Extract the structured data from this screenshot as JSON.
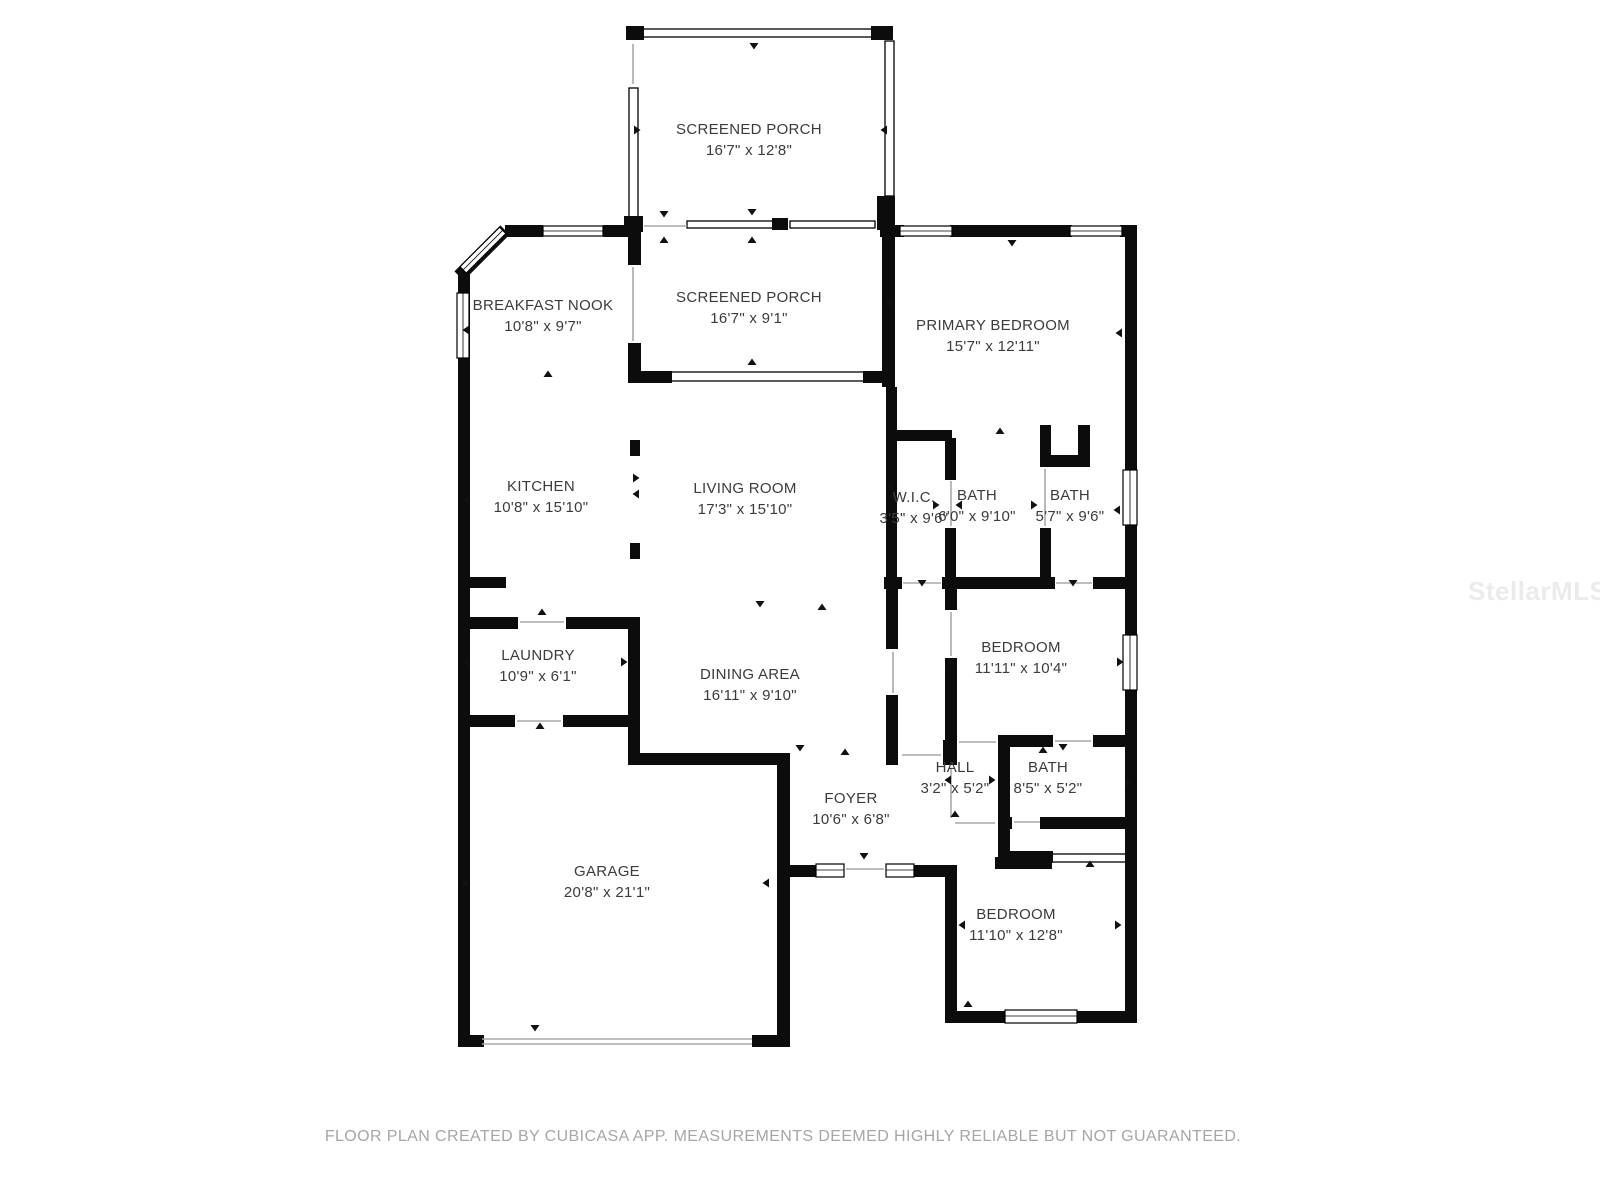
{
  "rooms": [
    {
      "id": "screened-porch-top",
      "name": "SCREENED PORCH",
      "dims": "16'7\" x 12'8\""
    },
    {
      "id": "breakfast-nook",
      "name": "BREAKFAST NOOK",
      "dims": "10'8\" x 9'7\""
    },
    {
      "id": "screened-porch-mid",
      "name": "SCREENED PORCH",
      "dims": "16'7\" x 9'1\""
    },
    {
      "id": "primary-bedroom",
      "name": "PRIMARY BEDROOM",
      "dims": "15'7\" x 12'11\""
    },
    {
      "id": "kitchen",
      "name": "KITCHEN",
      "dims": "10'8\" x 15'10\""
    },
    {
      "id": "living-room",
      "name": "LIVING ROOM",
      "dims": "17'3\" x 15'10\""
    },
    {
      "id": "wic",
      "name": "W.I.C.",
      "dims": "3'5\" x 9'6\""
    },
    {
      "id": "bath-primary",
      "name": "BATH",
      "dims": "6'0\" x 9'10\""
    },
    {
      "id": "bath-guest",
      "name": "BATH",
      "dims": "5'7\" x 9'6\""
    },
    {
      "id": "laundry",
      "name": "LAUNDRY",
      "dims": "10'9\" x 6'1\""
    },
    {
      "id": "dining-area",
      "name": "DINING AREA",
      "dims": "16'11\" x 9'10\""
    },
    {
      "id": "bedroom-middle",
      "name": "BEDROOM",
      "dims": "11'11\" x 10'4\""
    },
    {
      "id": "hall",
      "name": "HALL",
      "dims": "3'2\" x 5'2\""
    },
    {
      "id": "bath-hall",
      "name": "BATH",
      "dims": "8'5\" x 5'2\""
    },
    {
      "id": "foyer",
      "name": "FOYER",
      "dims": "10'6\" x 6'8\""
    },
    {
      "id": "garage",
      "name": "GARAGE",
      "dims": "20'8\" x 21'1\""
    },
    {
      "id": "bedroom-bottom",
      "name": "BEDROOM",
      "dims": "11'10\" x 12'8\""
    }
  ],
  "footer": {
    "text": "FLOOR PLAN CREATED BY CUBICASA APP. MEASUREMENTS DEEMED HIGHLY RELIABLE BUT NOT GUARANTEED."
  },
  "watermark": {
    "text": "StellarMLS"
  },
  "colors": {
    "wall": "#0c0c0c",
    "label": "#3b3b3b",
    "footer": "#a6a6a6",
    "watermark": "#ebebeb"
  }
}
